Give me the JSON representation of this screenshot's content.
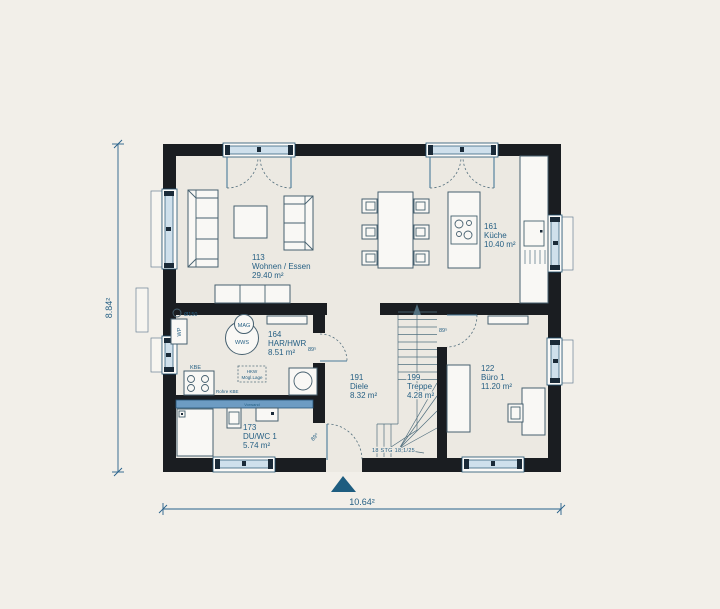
{
  "plan": {
    "rooms": [
      {
        "number": "113",
        "name": "Wohnen / Essen",
        "area": "29.40 m²"
      },
      {
        "number": "161",
        "name": "Küche",
        "area": "10.40 m²"
      },
      {
        "number": "164",
        "name": "HAR/HWR",
        "area": "8.51 m²"
      },
      {
        "number": "191",
        "name": "Diele",
        "area": "8.32 m²"
      },
      {
        "number": "199",
        "name": "Treppe",
        "area": "4.28 m²"
      },
      {
        "number": "122",
        "name": "Büro 1",
        "area": "11.20 m²"
      },
      {
        "number": "173",
        "name": "DU/WC 1",
        "area": "5.74 m²"
      }
    ],
    "dimensions": {
      "total_width": "10.64²",
      "total_height": "8.84²"
    },
    "door_labels": {
      "har": "89⁵",
      "buero": "89⁵",
      "entry": "89⁵"
    },
    "stairs_note": "18 STG 18,1/25",
    "labels": {
      "duct": "Ø150",
      "heat_pump": "WP",
      "mag": "MAG",
      "wws": "WWS",
      "kbe": "KBE",
      "rohre_kbe": "Rohre KBE",
      "hkw_line1": "HKW",
      "hkw_line2": "Mögl.Lage",
      "vorwand": "Vorwand"
    },
    "colors": {
      "wall": "#1a1d21",
      "floor": "#ece9e2",
      "outside": "#f2efe9",
      "line": "#46606f",
      "text": "#266084",
      "window_band": "#cfe0ec",
      "window_frame": "#20506e",
      "accent_blue": "#6d9cc3",
      "triangle": "#1e5d80"
    }
  }
}
